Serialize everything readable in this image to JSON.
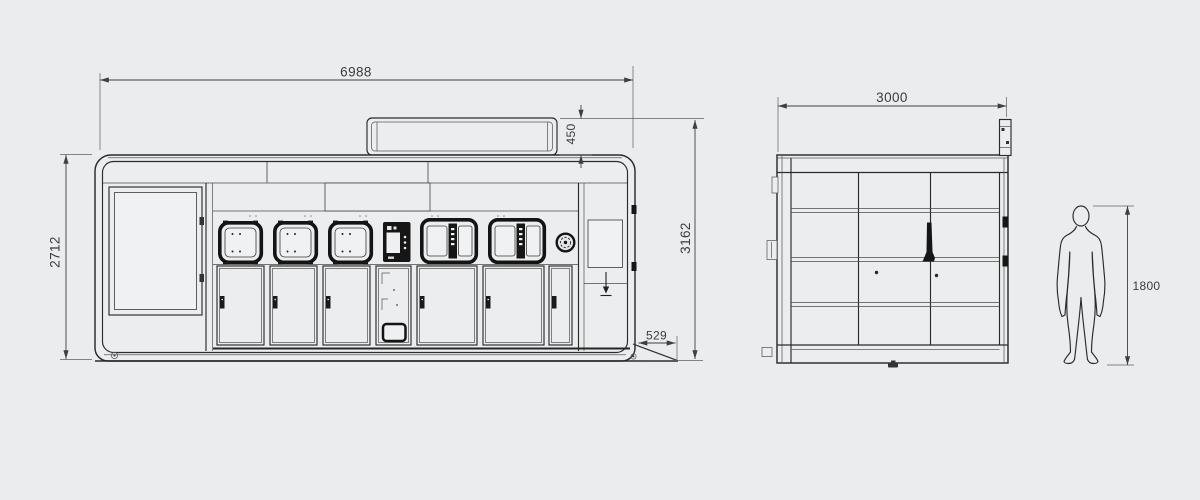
{
  "drawing": {
    "background_color": "#ebecee",
    "line_color": "#2b2b2b",
    "dimension_text_color": "#3b3b3b",
    "front_view": {
      "dimensions": {
        "overall_width": "6988",
        "body_height": "2712",
        "roof_unit_height": "450",
        "overall_height": "3162",
        "ramp_depth": "529"
      }
    },
    "end_view": {
      "dimensions": {
        "overall_width": "3000"
      }
    },
    "human_figure": {
      "dimensions": {
        "height": "1800"
      }
    }
  }
}
